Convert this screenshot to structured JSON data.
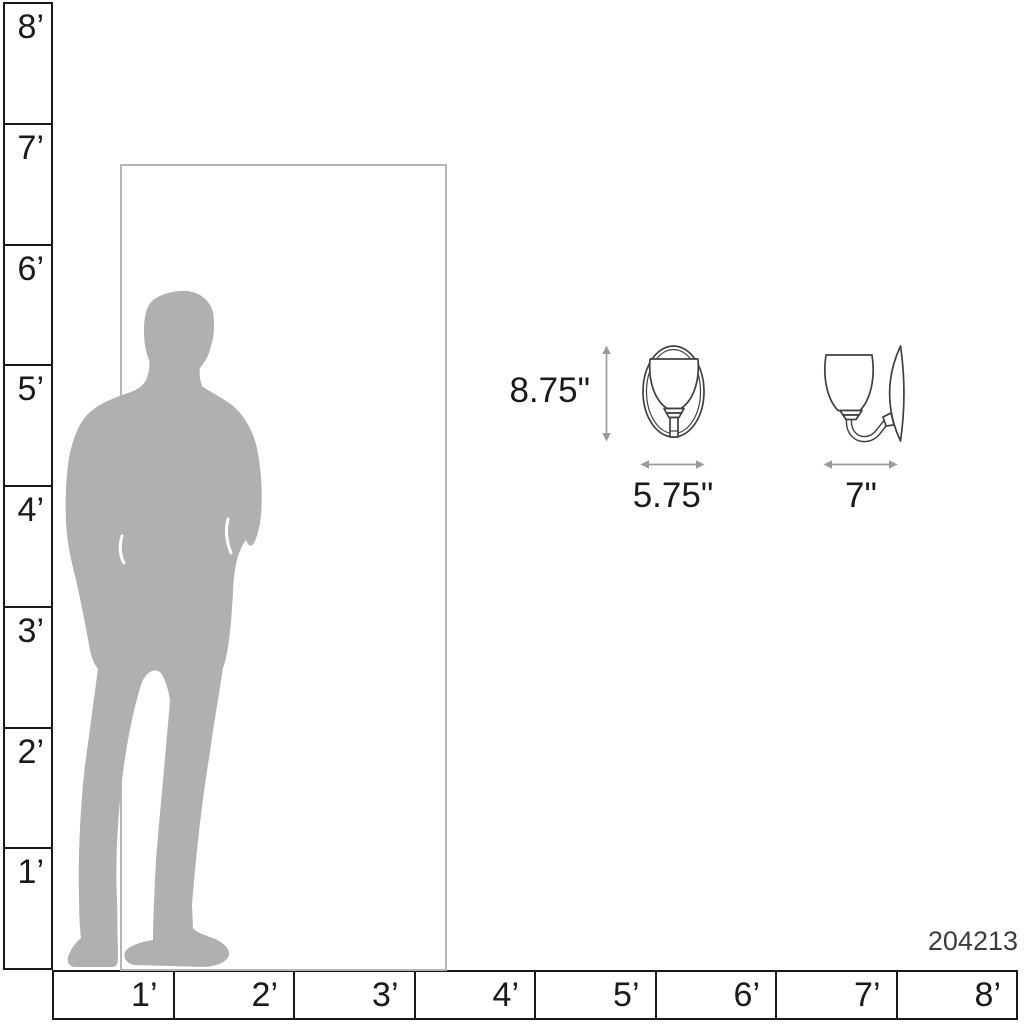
{
  "title": "Wall sconce scale diagram",
  "product_number": "204213",
  "dimensions": {
    "height": "8.75\"",
    "width": "5.75\"",
    "depth": "7\""
  },
  "rulers": {
    "vertical": {
      "unit": "feet",
      "labels": [
        "8’",
        "7’",
        "6’",
        "5’",
        "4’",
        "3’",
        "2’",
        "1’"
      ]
    },
    "horizontal": {
      "unit": "feet",
      "labels": [
        "1’",
        "2’",
        "3’",
        "4’",
        "5’",
        "6’",
        "7’",
        "8’"
      ]
    }
  },
  "scene": {
    "person": "standing-man-silhouette",
    "door": "door-outline",
    "fixture_front": "sconce-front-view",
    "fixture_side": "sconce-side-view"
  },
  "colors": {
    "background": "#ffffff",
    "silhouette": "#b0b0b0",
    "door_outline": "#b5b5b5",
    "dimension_arrow": "#9a9a9a",
    "fixture_line": "#404040",
    "ruler_line": "#1a1a1a",
    "text": "#1a1a1a",
    "product_number_text": "#3d3d3d"
  }
}
